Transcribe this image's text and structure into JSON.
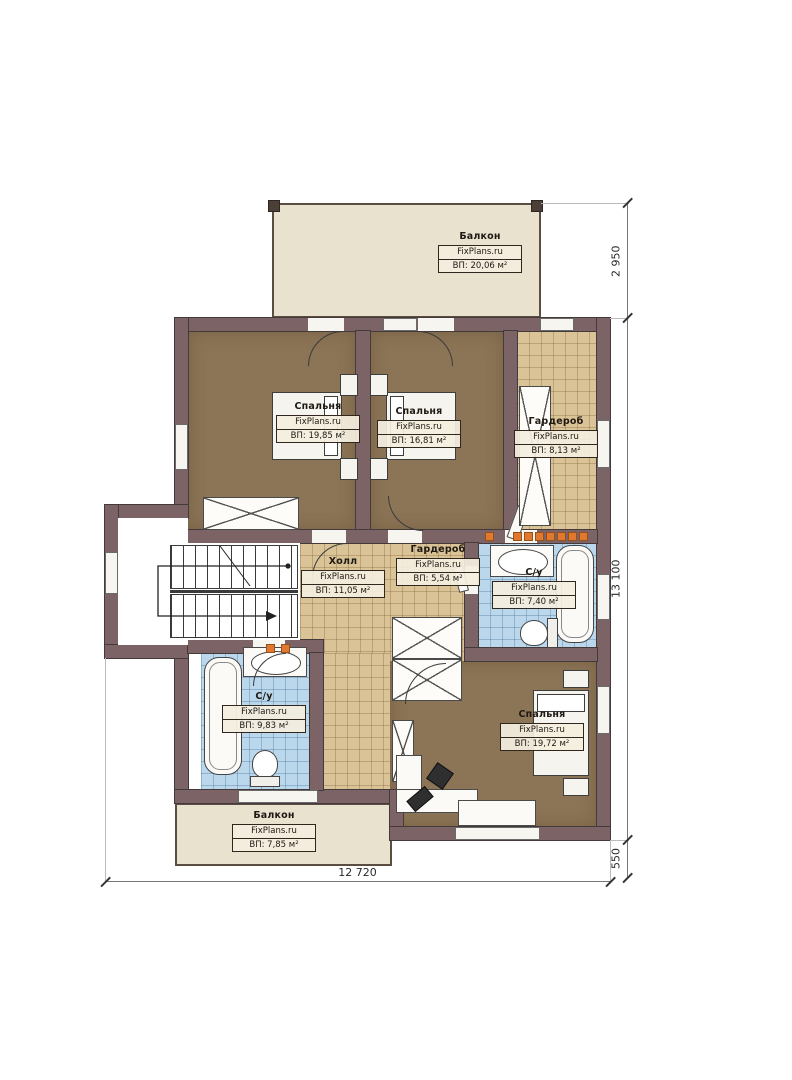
{
  "brand": "FixPlans.ru",
  "rooms": {
    "balcony_top": {
      "name": "Балкон",
      "area": "ВП: 20,06 м²"
    },
    "bedroom_1": {
      "name": "Спальня",
      "area": "ВП: 19,85 м²"
    },
    "bedroom_2": {
      "name": "Спальня",
      "area": "ВП: 16,81 м²"
    },
    "wardrobe_1": {
      "name": "Гардероб",
      "area": "ВП: 8,13 м²"
    },
    "hall": {
      "name": "Холл",
      "area": "ВП: 11,05 м²"
    },
    "wardrobe_2": {
      "name": "Гардероб",
      "area": "ВП: 5,54 м²"
    },
    "bathroom_right": {
      "name": "С/у",
      "area": "ВП: 7,40 м²"
    },
    "bathroom_left": {
      "name": "С/у",
      "area": "ВП: 9,83 м²"
    },
    "bedroom_3": {
      "name": "Спальня",
      "area": "ВП: 19,72 м²"
    },
    "balcony_bottom": {
      "name": "Балкон",
      "area": "ВП: 7,85 м²"
    }
  },
  "dimensions": {
    "balcony_depth": "2 950",
    "house_height": "13 100",
    "bottom_step": "550",
    "house_width": "12 720"
  },
  "colors": {
    "wall": "#7c6365",
    "bedroom_floor": "#8c7456",
    "tile_tan": "#dac397",
    "tile_blue": "#bad7ec",
    "balcony": "#e9e2cf",
    "marker_orange": "#e2772e"
  }
}
